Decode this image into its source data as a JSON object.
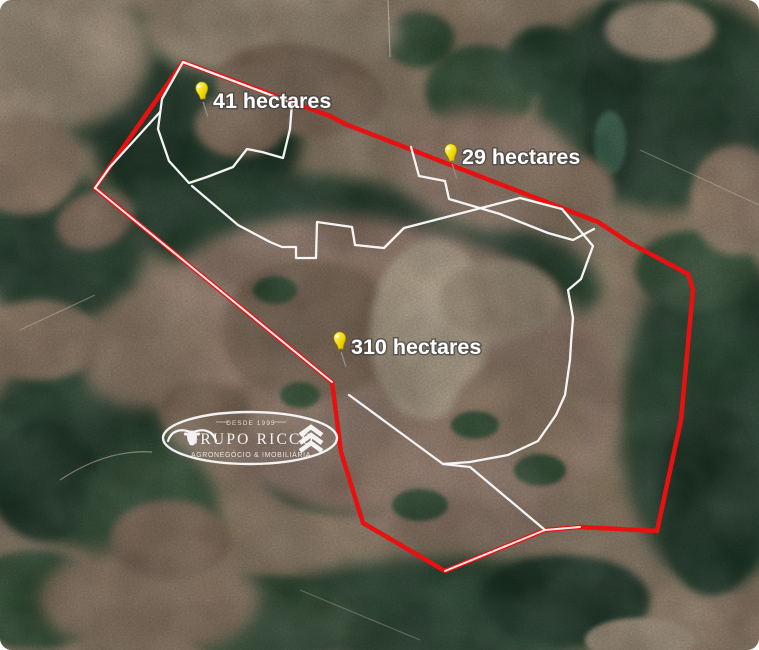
{
  "map": {
    "kind": "satellite",
    "markers": [
      {
        "id": "parcel-41",
        "label": "41 hectares"
      },
      {
        "id": "parcel-29",
        "label": "29 hectares"
      },
      {
        "id": "parcel-310",
        "label": "310 hectares"
      }
    ],
    "colors": {
      "outer_boundary": "#e81111",
      "inner_boundary": "#ffffff",
      "pin": "#f2dc00"
    }
  },
  "watermark": {
    "since": "DESDE 1995",
    "brand": "GRUPO RICCO",
    "tagline": "AGRONEGÓCIO & IMOBILIÁRIA"
  }
}
